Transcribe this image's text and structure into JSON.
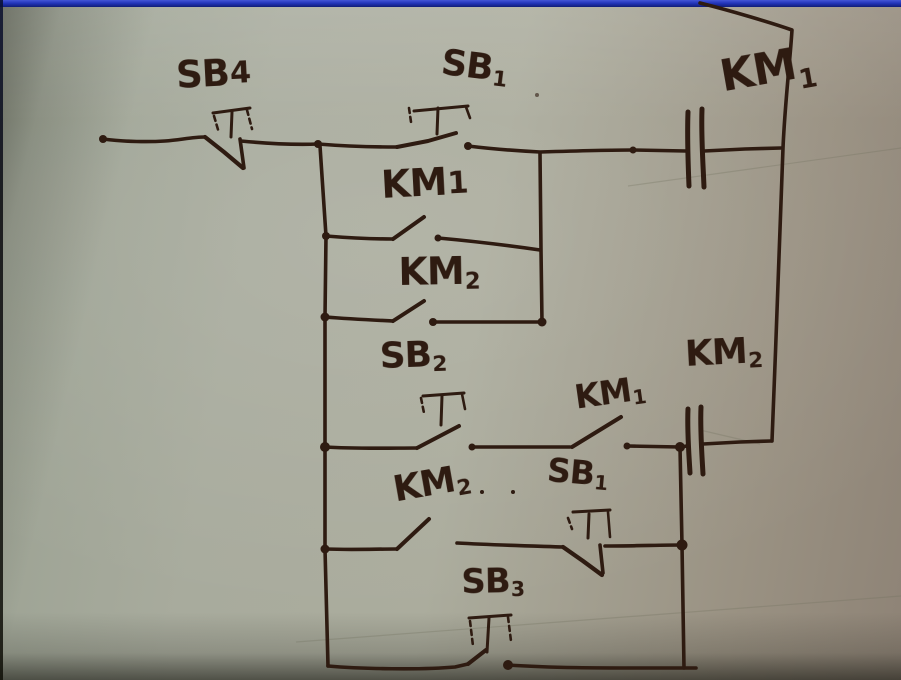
{
  "image": {
    "kind": "photograph of a hand-drawn electrical relay control circuit (ladder diagram) on paper",
    "width": 901,
    "height": 680
  },
  "colors": {
    "ink": "#2e1b11",
    "paper": "#a7aa9c",
    "top_border_blue": "#2335bb",
    "edge_shadow": "#101008"
  },
  "labels": {
    "sb4": {
      "main": "SB",
      "sub": "4"
    },
    "sb1_top": {
      "main": "SB",
      "sub": "1"
    },
    "km1_coil": {
      "main": "KM",
      "sub": "1"
    },
    "km1_contact_a": {
      "main": "KM",
      "sub": "1"
    },
    "km2_contact_a": {
      "main": "KM",
      "sub": "2"
    },
    "sb2": {
      "main": "SB",
      "sub": "2"
    },
    "km1_contact_b": {
      "main": "KM",
      "sub": "1"
    },
    "km2_coil": {
      "main": "KM",
      "sub": "2"
    },
    "km2_contact_b": {
      "main": "KM",
      "sub": "2"
    },
    "sb1_lower": {
      "main": "SB",
      "sub": "1"
    },
    "sb3": {
      "main": "SB",
      "sub": "3"
    }
  },
  "circuit": {
    "components": [
      {
        "id": "SB4",
        "type": "NC pushbutton",
        "location": "top rung, left"
      },
      {
        "id": "SB1",
        "type": "NO pushbutton",
        "location": "top rung, middle"
      },
      {
        "id": "KM1",
        "type": "contactor coil",
        "location": "top rung, right"
      },
      {
        "id": "KM1",
        "type": "NO auxiliary contact",
        "location": "first parallel self-hold branch"
      },
      {
        "id": "KM2",
        "type": "NO auxiliary contact",
        "location": "second parallel self-hold branch"
      },
      {
        "id": "SB2",
        "type": "NO pushbutton",
        "location": "middle rung, left"
      },
      {
        "id": "KM1",
        "type": "NO auxiliary contact",
        "location": "middle rung, right"
      },
      {
        "id": "KM2",
        "type": "contactor coil",
        "location": "middle rung, far right"
      },
      {
        "id": "KM2",
        "type": "NO auxiliary contact",
        "location": "lower rung, left"
      },
      {
        "id": "SB1",
        "type": "NC pushbutton",
        "location": "lower rung, right"
      },
      {
        "id": "SB3",
        "type": "NO pushbutton",
        "location": "bottom rung"
      }
    ]
  }
}
